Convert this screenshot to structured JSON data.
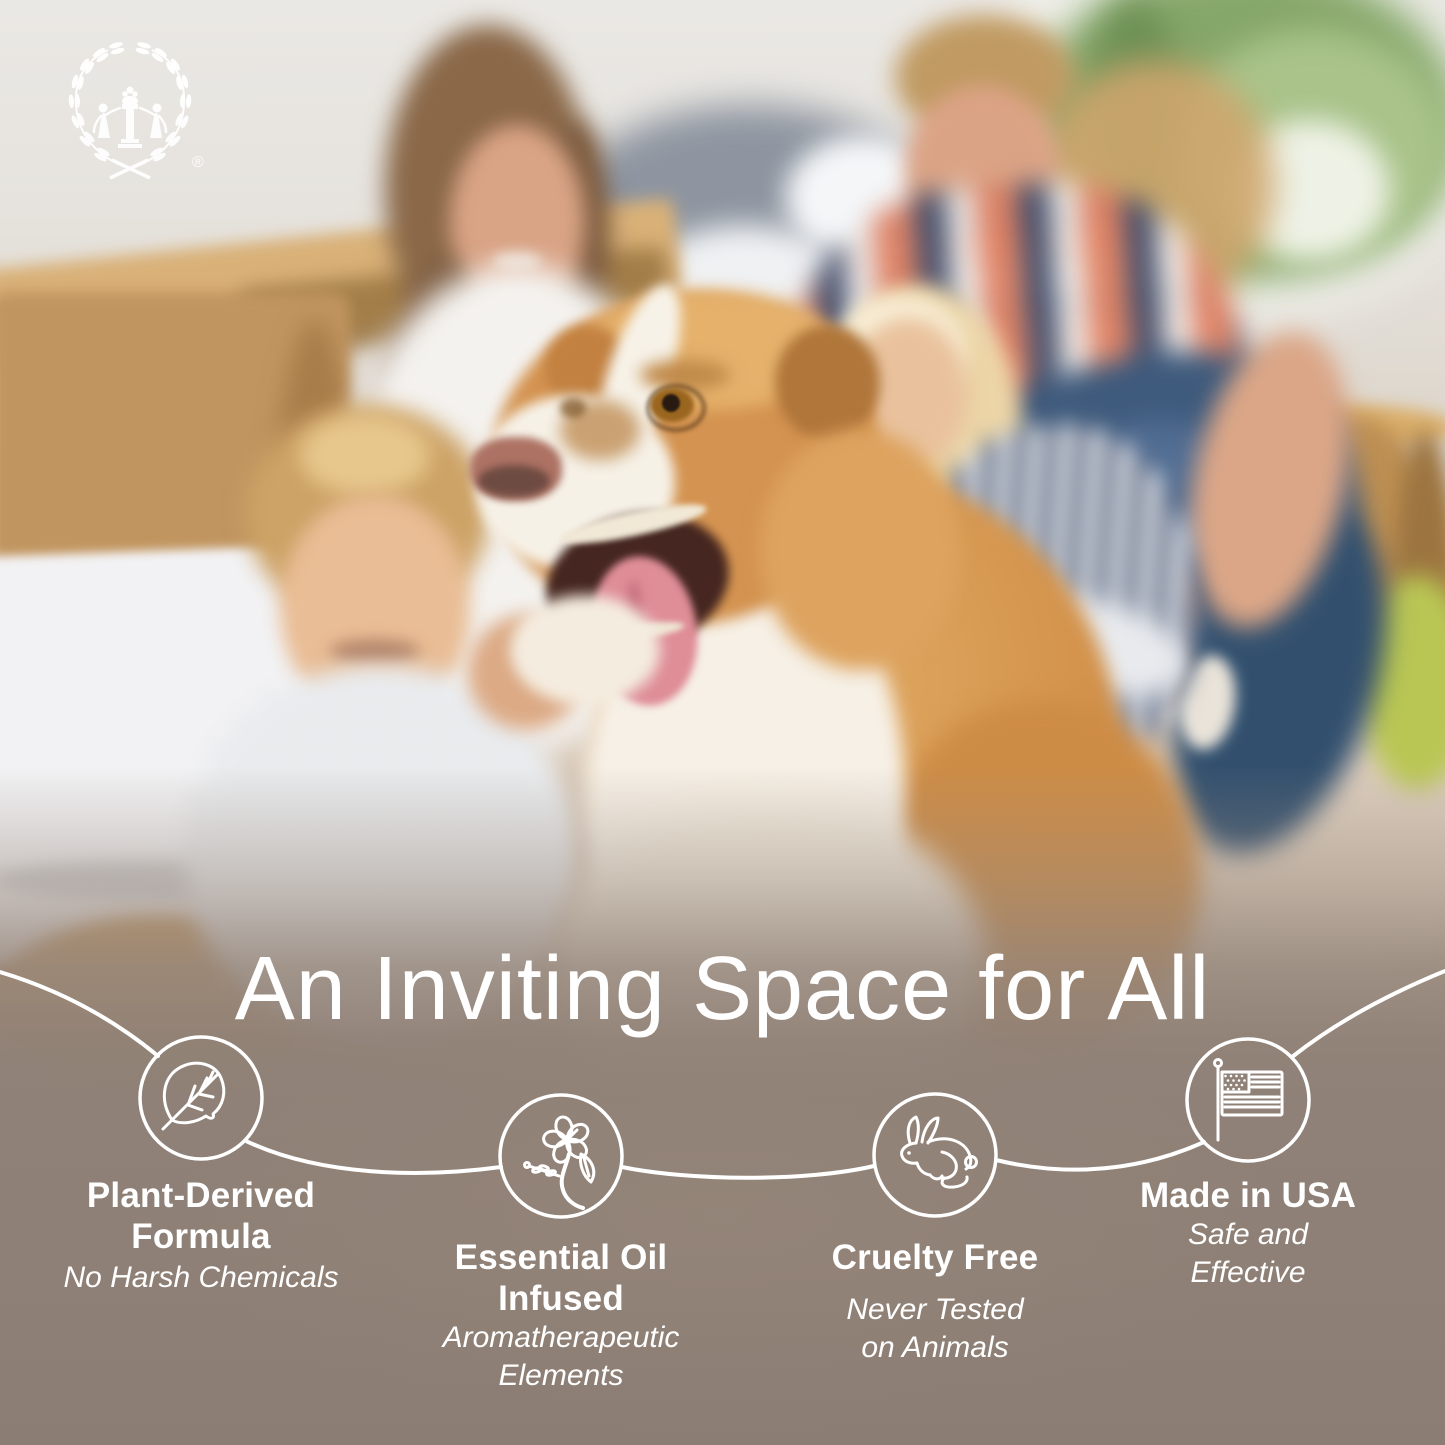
{
  "brand": {
    "logo_motif": "laurel-wreath-with-two-figures-and-column",
    "registered_mark": "®"
  },
  "hero": {
    "title": "An Inviting Space for All"
  },
  "features": [
    {
      "id": "plant-derived",
      "icon": "leaf-icon",
      "title": "Plant-Derived Formula",
      "title_lines": [
        "Plant-Derived",
        "Formula"
      ],
      "subtitle": "No Harsh Chemicals",
      "subtitle_lines": [
        "No Harsh Chemicals"
      ]
    },
    {
      "id": "essential-oil",
      "icon": "flower-icon",
      "title": "Essential Oil Infused",
      "title_lines": [
        "Essential Oil",
        "Infused"
      ],
      "subtitle": "Aromatherapeutic Elements",
      "subtitle_lines": [
        "Aromatherapeutic",
        "Elements"
      ]
    },
    {
      "id": "cruelty-free",
      "icon": "rabbit-icon",
      "title": "Cruelty Free",
      "title_lines": [
        "Cruelty Free"
      ],
      "subtitle": "Never Tested on Animals",
      "subtitle_lines": [
        "Never Tested",
        "on Animals"
      ]
    },
    {
      "id": "made-in-usa",
      "icon": "usa-flag-icon",
      "title": "Made in USA",
      "title_lines": [
        "Made in USA"
      ],
      "subtitle": "Safe and Effective",
      "subtitle_lines": [
        "Safe and",
        "Effective"
      ]
    }
  ],
  "photo": {
    "subject": "family with golden-and-white collie dog among moving boxes"
  },
  "palette": {
    "overlay_taupe": "#8D7F76",
    "text_white": "#FFFFFF",
    "line_white": "#FFFFFF",
    "cardboard": "#C5975C",
    "dog_gold": "#D79754",
    "dog_cream": "#F5EFE5",
    "denim_blue": "#3E5A7C",
    "plaid_coral": "#E08264",
    "plaid_navy": "#3E4A68",
    "plant_green": "#87A86B",
    "pillow_lime": "#B9C654"
  }
}
